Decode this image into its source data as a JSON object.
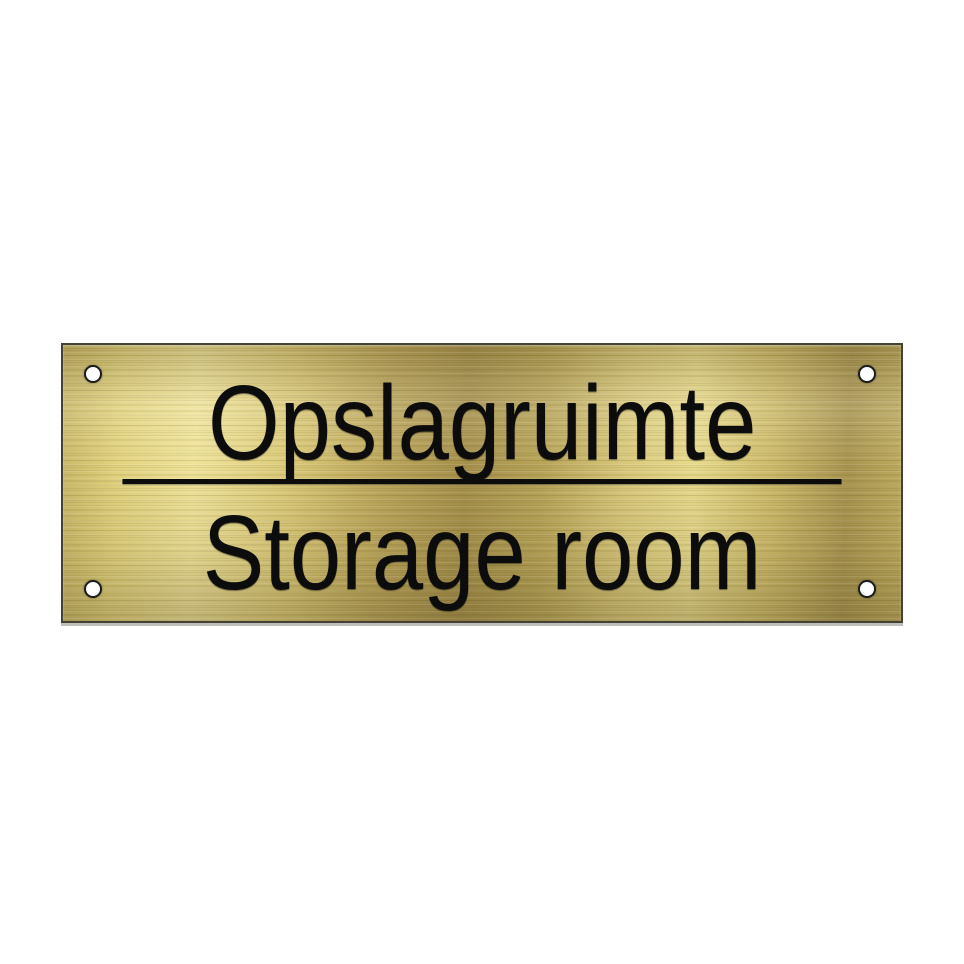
{
  "sign": {
    "line1": "Opslagruimte",
    "line2": "Storage room"
  },
  "colors": {
    "background": "#ffffff",
    "brass_light": "#efe39a",
    "brass_mid": "#d6c478",
    "brass_dark": "#a6914c",
    "engraving": "#0c0c0c",
    "hole_fill": "#ffffff",
    "hole_ring": "#1c1c1c",
    "plate_border": "#454233"
  }
}
